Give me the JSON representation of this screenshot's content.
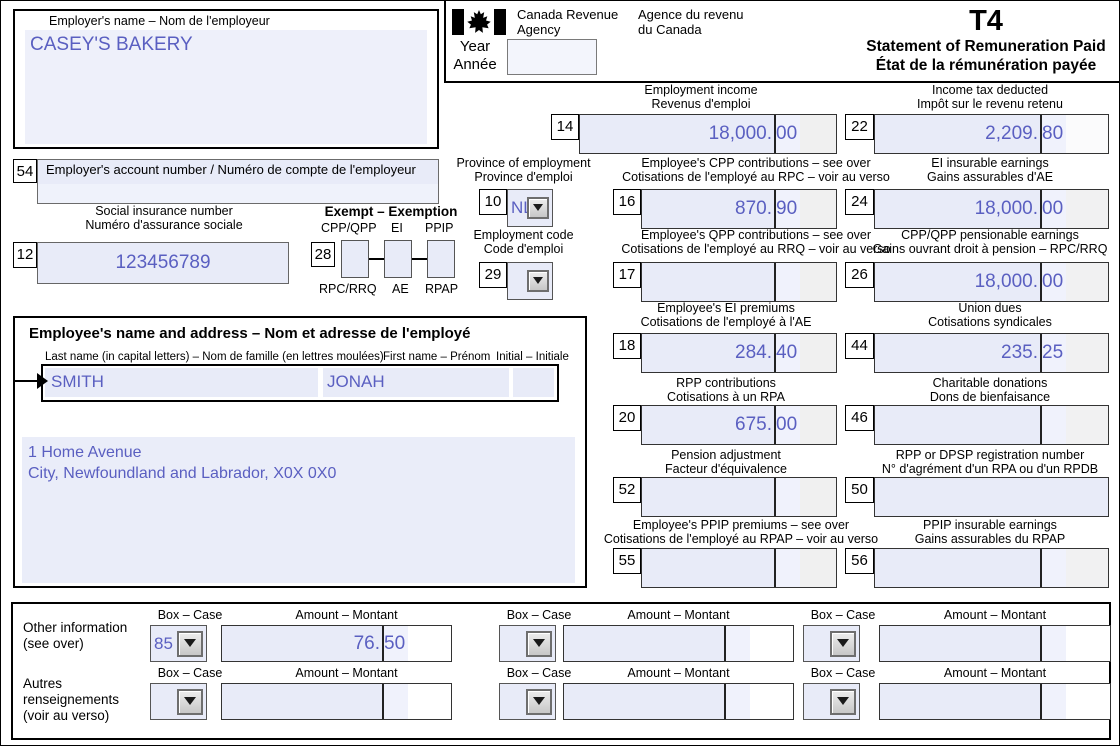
{
  "header": {
    "employer_name_label": "Employer's name – Nom de l'employeur",
    "employer_name_value": "CASEY'S BAKERY",
    "agency_en_line1": "Canada Revenue",
    "agency_en_line2": "Agency",
    "agency_fr_line1": "Agence du revenu",
    "agency_fr_line2": "du Canada",
    "year_label_en": "Year",
    "year_label_fr": "Année",
    "year_value": "",
    "form_code": "T4",
    "title_en": "Statement of Remuneration Paid",
    "title_fr": "État de la rémunération payée"
  },
  "employer_account": {
    "no": "54",
    "label": "Employer's account number / Numéro de compte de l'employeur",
    "value": ""
  },
  "sin": {
    "no": "12",
    "label_en": "Social insurance number",
    "label_fr": "Numéro d'assurance sociale",
    "value": "123456789"
  },
  "exempt": {
    "no": "28",
    "title": "Exempt – Exemption",
    "top_labels": [
      "CPP/QPP",
      "EI",
      "PPIP"
    ],
    "bottom_labels": [
      "RPC/RRQ",
      "AE",
      "RPAP"
    ],
    "checked": [
      false,
      false,
      false
    ]
  },
  "province": {
    "no": "10",
    "label_en": "Province of employment",
    "label_fr": "Province d'emploi",
    "value": "NL"
  },
  "employment_code": {
    "no": "29",
    "label_en": "Employment code",
    "label_fr": "Code d'emploi",
    "value": ""
  },
  "employee": {
    "section_title": "Employee's name and address – Nom et adresse de l'employé",
    "last_name_label": "Last name (in capital letters) – Nom de famille (en lettres moulées)",
    "first_name_label": "First name – Prénom",
    "initial_label": "Initial – Initiale",
    "last_name": "SMITH",
    "first_name": "JONAH",
    "initial": "",
    "address_line1": "1 Home Avenue",
    "address_line2": "City, Newfoundland and Labrador, X0X 0X0"
  },
  "boxes": [
    {
      "no": "14",
      "label_en": "Employment income",
      "label_fr": "Revenus d'emploi",
      "value": "18,000.00"
    },
    {
      "no": "22",
      "label_en": "Income tax deducted",
      "label_fr": "Impôt sur le revenu retenu",
      "value": "2,209.80"
    },
    {
      "no": "16",
      "label_en": "Employee's CPP contributions – see over",
      "label_fr": "Cotisations de l'employé au RPC – voir au verso",
      "value": "870.90"
    },
    {
      "no": "24",
      "label_en": "EI insurable earnings",
      "label_fr": "Gains assurables d'AE",
      "value": "18,000.00"
    },
    {
      "no": "17",
      "label_en": "Employee's QPP contributions – see over",
      "label_fr": "Cotisations de l'employé au RRQ – voir au verso",
      "value": ""
    },
    {
      "no": "26",
      "label_en": "CPP/QPP pensionable earnings",
      "label_fr": "Gains ouvrant droit à pension – RPC/RRQ",
      "value": "18,000.00"
    },
    {
      "no": "18",
      "label_en": "Employee's EI premiums",
      "label_fr": "Cotisations de l'employé à l'AE",
      "value": "284.40"
    },
    {
      "no": "44",
      "label_en": "Union dues",
      "label_fr": "Cotisations syndicales",
      "value": "235.25"
    },
    {
      "no": "20",
      "label_en": "RPP contributions",
      "label_fr": "Cotisations à un RPA",
      "value": "675.00"
    },
    {
      "no": "46",
      "label_en": "Charitable donations",
      "label_fr": "Dons de bienfaisance",
      "value": ""
    },
    {
      "no": "52",
      "label_en": "Pension adjustment",
      "label_fr": "Facteur d'équivalence",
      "value": ""
    },
    {
      "no": "50",
      "label_en": "RPP or DPSP registration number",
      "label_fr": "N° d'agrément d'un RPA ou d'un RPDB",
      "value": ""
    },
    {
      "no": "55",
      "label_en": "Employee's PPIP premiums – see over",
      "label_fr": "Cotisations de l'employé au RPAP – voir au verso",
      "value": ""
    },
    {
      "no": "56",
      "label_en": "PPIP insurable earnings",
      "label_fr": "Gains assurables du RPAP",
      "value": ""
    }
  ],
  "other_info": {
    "left_en_line1": "Other information",
    "left_en_line2": "(see over)",
    "left_fr_line1": "Autres",
    "left_fr_line2": "renseignements",
    "left_fr_line3": "(voir au verso)",
    "box_case_label": "Box – Case",
    "amount_label": "Amount – Montant",
    "row1": [
      {
        "box": "85",
        "amount": "76.50"
      },
      {
        "box": "",
        "amount": ""
      },
      {
        "box": "",
        "amount": ""
      }
    ],
    "row2": [
      {
        "box": "",
        "amount": ""
      },
      {
        "box": "",
        "amount": ""
      },
      {
        "box": "",
        "amount": ""
      }
    ]
  }
}
